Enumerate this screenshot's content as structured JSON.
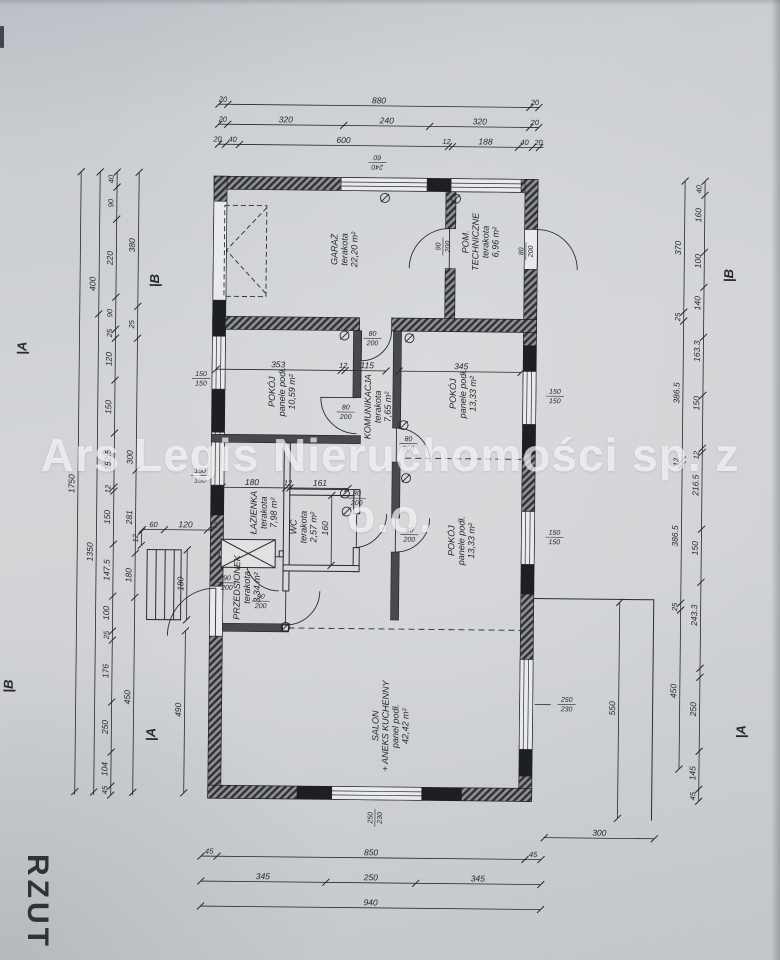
{
  "watermark": {
    "line1": "Ars Legis Nieruchomości sp. z",
    "line2": "o.o."
  },
  "title_block": {
    "label": "RZUT"
  },
  "colors": {
    "paper": "#d3d5d8",
    "ink": "#26282a",
    "wall_dark": "#47494c",
    "watermark": "rgba(255,255,255,0.66)"
  },
  "plan": {
    "rooms": [
      {
        "name_lines": [
          "GARAŻ"
        ],
        "finish": "terakota",
        "area": "22,20 m²",
        "x": 345,
        "y": 250
      },
      {
        "name_lines": [
          "POM.",
          "TECHNICZNE"
        ],
        "finish": "terakota",
        "area": "6,96 m²",
        "x": 481,
        "y": 241
      },
      {
        "name_lines": [
          "POKÓJ"
        ],
        "finish": "panele podł.",
        "area": "10,59 m²",
        "x": 284,
        "y": 393
      },
      {
        "name_lines": [
          "KOMUNIKACJA"
        ],
        "finish": "terakota",
        "area": "7,65 m²",
        "x": 380,
        "y": 407
      },
      {
        "name_lines": [
          "POKÓJ"
        ],
        "finish": "panele podł.",
        "area": "13,33 m²",
        "x": 465,
        "y": 393
      },
      {
        "name_lines": [
          "ŁAZIENKA"
        ],
        "finish": "terakota",
        "area": "7,98 m²",
        "x": 267,
        "y": 514
      },
      {
        "name_lines": [
          "WC"
        ],
        "finish": "terakota",
        "area": "2,57 m²",
        "x": 307,
        "y": 528
      },
      {
        "name_lines": [
          "PRZEDSIONEK"
        ],
        "finish": "terakota",
        "area": "3,34 m²",
        "x": 251,
        "y": 589
      },
      {
        "name_lines": [
          "POKÓJ"
        ],
        "finish": "panele podł.",
        "area": "13,33 m²",
        "x": 465,
        "y": 540
      },
      {
        "name_lines": [
          "SALON",
          "+ ANEKS KUCHENNY"
        ],
        "finish": "panel podł.",
        "area": "42,42 m²",
        "x": 396,
        "y": 726
      }
    ],
    "hdims": [
      {
        "y": 106,
        "x1": 215,
        "x2": 535,
        "ticks": [
          215,
          224,
          526,
          535
        ],
        "labels": [
          {
            "t": "20",
            "x": 219
          },
          {
            "t": "880",
            "x": 375
          },
          {
            "t": "20",
            "x": 531
          }
        ]
      },
      {
        "y": 126,
        "x1": 215,
        "x2": 535,
        "ticks": [
          215,
          224,
          340,
          426,
          526,
          535
        ],
        "labels": [
          {
            "t": "20",
            "x": 219
          },
          {
            "t": "320",
            "x": 282
          },
          {
            "t": "240",
            "x": 383
          },
          {
            "t": "320",
            "x": 476
          },
          {
            "t": "20",
            "x": 531
          }
        ]
      },
      {
        "y": 146,
        "x1": 215,
        "x2": 540,
        "ticks": [
          215,
          222,
          236,
          445,
          449,
          515,
          529,
          536
        ],
        "labels": [
          {
            "t": "20",
            "x": 214
          },
          {
            "t": "40",
            "x": 229
          },
          {
            "t": "600",
            "x": 340
          },
          {
            "t": "12",
            "x": 443
          },
          {
            "t": "188",
            "x": 482
          },
          {
            "t": "40",
            "x": 521
          },
          {
            "t": "20",
            "x": 535
          }
        ]
      },
      {
        "y": 858,
        "x1": 205,
        "x2": 545,
        "ticks": [
          205,
          221,
          529,
          545
        ],
        "labels": [
          {
            "t": "45",
            "x": 213
          },
          {
            "t": "850",
            "x": 375
          },
          {
            "t": "45",
            "x": 537
          }
        ]
      },
      {
        "y": 883,
        "x1": 205,
        "x2": 545,
        "ticks": [
          205,
          330,
          420,
          545
        ],
        "labels": [
          {
            "t": "345",
            "x": 267
          },
          {
            "t": "250",
            "x": 375
          },
          {
            "t": "345",
            "x": 482
          }
        ]
      },
      {
        "y": 908,
        "x1": 205,
        "x2": 545,
        "ticks": [
          205,
          545
        ],
        "labels": [
          {
            "t": "940",
            "x": 375
          }
        ]
      },
      {
        "y": 836,
        "x1": 548,
        "x2": 658,
        "ticks": [
          548,
          658
        ],
        "labels": [
          {
            "t": "300",
            "x": 603
          }
        ]
      },
      {
        "y": 532,
        "x1": 143,
        "x2": 212,
        "ticks": [
          143,
          165,
          208
        ],
        "labels": [
          {
            "t": "60",
            "x": 154
          },
          {
            "t": "120",
            "x": 186
          },
          {
            "t": "12",
            "x": 214
          }
        ]
      },
      {
        "y": 371,
        "x1": 215,
        "x2": 385,
        "ticks": [
          215,
          340,
          344,
          385
        ],
        "labels": [
          {
            "t": "353",
            "x": 277
          },
          {
            "t": "12",
            "x": 342
          },
          {
            "t": "115",
            "x": 366
          }
        ]
      },
      {
        "y": 371,
        "x1": 398,
        "x2": 520,
        "ticks": [
          398,
          520
        ],
        "labels": [
          {
            "t": "345",
            "x": 460
          }
        ]
      },
      {
        "y": 489,
        "x1": 222,
        "x2": 348,
        "ticks": [
          222,
          286,
          290,
          348
        ],
        "labels": [
          {
            "t": "180",
            "x": 252
          },
          {
            "t": "12",
            "x": 288
          },
          {
            "t": "161",
            "x": 320
          }
        ]
      }
    ],
    "vdims": [
      {
        "x": 114,
        "y1": 175,
        "y2": 798,
        "ticks": [
          175,
          190,
          222,
          300,
          332,
          341,
          383,
          436,
          490,
          494,
          547,
          599,
          634,
          643,
          705,
          755,
          789,
          798
        ],
        "labels": [
          {
            "t": "40",
            "y": 182
          },
          {
            "t": "90",
            "y": 206
          },
          {
            "t": "220",
            "y": 261
          },
          {
            "t": "90",
            "y": 316
          },
          {
            "t": "25",
            "y": 336
          },
          {
            "t": "120",
            "y": 362
          },
          {
            "t": "150",
            "y": 410
          },
          {
            "t": "152.5",
            "y": 463
          },
          {
            "t": "12",
            "y": 492
          },
          {
            "t": "150",
            "y": 520
          },
          {
            "t": "147.5",
            "y": 573
          },
          {
            "t": "100",
            "y": 616
          },
          {
            "t": "25",
            "y": 638
          },
          {
            "t": "176",
            "y": 674
          },
          {
            "t": "250",
            "y": 730
          },
          {
            "t": "104",
            "y": 772
          },
          {
            "t": "45",
            "y": 793
          }
        ]
      },
      {
        "x": 136,
        "y1": 175,
        "y2": 798,
        "ticks": [
          175,
          309,
          341,
          473,
          556,
          600,
          795
        ],
        "labels": [
          {
            "t": "380",
            "y": 248
          },
          {
            "t": "25",
            "y": 327
          },
          {
            "t": "300",
            "y": 460
          },
          {
            "t": "281",
            "y": 520
          },
          {
            "t": "180",
            "y": 578
          },
          {
            "t": "450",
            "y": 700
          }
        ]
      },
      {
        "x": 97,
        "y1": 175,
        "y2": 798,
        "ticks": [
          175,
          317,
          795
        ],
        "labels": [
          {
            "t": "400",
            "y": 287
          },
          {
            "t": "1350",
            "y": 555
          }
        ]
      },
      {
        "x": 78,
        "y1": 175,
        "y2": 798,
        "ticks": [
          175,
          795
        ],
        "labels": [
          {
            "t": "1750",
            "y": 487
          }
        ]
      },
      {
        "x": 188,
        "y1": 552,
        "y2": 622,
        "ticks": [
          552,
          622
        ],
        "labels": [
          {
            "t": "180",
            "y": 586
          }
        ]
      },
      {
        "x": 187,
        "y1": 633,
        "y2": 795,
        "ticks": [
          633,
          795
        ],
        "labels": [
          {
            "t": "490",
            "y": 712
          }
        ]
      },
      {
        "x": 332,
        "y1": 496,
        "y2": 566,
        "ticks": [
          496,
          566
        ],
        "labels": [
          {
            "t": "160",
            "y": 529
          }
        ]
      },
      {
        "x": 142,
        "y1": 534,
        "y2": 548,
        "ticks": [
          534,
          548
        ],
        "labels": [
          {
            "t": "12",
            "y": 541
          }
        ]
      },
      {
        "x": 682,
        "y1": 178,
        "y2": 766,
        "ticks": [
          178,
          309,
          318,
          457,
          462,
          600,
          607,
          766
        ],
        "labels": [
          {
            "t": "370",
            "y": 245
          },
          {
            "t": "25",
            "y": 314
          },
          {
            "t": "386.5",
            "y": 390
          },
          {
            "t": "12",
            "y": 459
          },
          {
            "t": "386.5",
            "y": 533
          },
          {
            "t": "25",
            "y": 604
          },
          {
            "t": "450",
            "y": 688
          }
        ]
      },
      {
        "x": 702,
        "y1": 178,
        "y2": 798,
        "ticks": [
          178,
          192,
          249,
          284,
          334,
          392,
          445,
          449,
          526,
          579,
          665,
          674,
          748,
          786,
          798
        ],
        "labels": [
          {
            "t": "40",
            "y": 186
          },
          {
            "t": "160",
            "y": 212
          },
          {
            "t": "100",
            "y": 258
          },
          {
            "t": "140",
            "y": 300
          },
          {
            "t": "163.3",
            "y": 348
          },
          {
            "t": "150",
            "y": 400
          },
          {
            "t": "12",
            "y": 452
          },
          {
            "t": "216.5",
            "y": 482
          },
          {
            "t": "150",
            "y": 545
          },
          {
            "t": "243.3",
            "y": 612
          },
          {
            "t": "250",
            "y": 706
          },
          {
            "t": "145",
            "y": 770
          },
          {
            "t": "45",
            "y": 793
          }
        ]
      },
      {
        "x": 621,
        "y1": 600,
        "y2": 816,
        "ticks": [
          600,
          816
        ],
        "labels": [
          {
            "t": "550",
            "y": 706
          }
        ]
      }
    ],
    "opening_labels": [
      {
        "top": "90",
        "bottom": "200",
        "x": 440,
        "y": 246,
        "rot": -90
      },
      {
        "top": "80",
        "bottom": "200",
        "x": 523,
        "y": 250,
        "rot": -90
      },
      {
        "top": "80",
        "bottom": "200",
        "x": 371,
        "y": 338,
        "rot": 0
      },
      {
        "top": "80",
        "bottom": "200",
        "x": 345,
        "y": 412,
        "rot": 0
      },
      {
        "top": "80",
        "bottom": "200",
        "x": 408,
        "y": 443,
        "rot": 0
      },
      {
        "top": "80",
        "bottom": "200",
        "x": 410,
        "y": 534,
        "rot": 0
      },
      {
        "top": "80",
        "bottom": "200",
        "x": 357,
        "y": 498,
        "rot": 0
      },
      {
        "top": "90",
        "bottom": "200",
        "x": 262,
        "y": 602,
        "rot": 0
      },
      {
        "top": "90",
        "bottom": "200",
        "x": 228,
        "y": 584,
        "rot": 0
      },
      {
        "top": "150",
        "bottom": "150",
        "x": 200,
        "y": 380,
        "rot": 0
      },
      {
        "top": "150",
        "bottom": "150",
        "x": 200,
        "y": 477,
        "rot": 0
      },
      {
        "top": "150",
        "bottom": "150",
        "x": 554,
        "y": 394,
        "rot": 0
      },
      {
        "top": "150",
        "bottom": "150",
        "x": 555,
        "y": 535,
        "rot": 0
      },
      {
        "top": "240",
        "bottom": "60",
        "x": 374,
        "y": 163,
        "rot": 180
      },
      {
        "top": "250",
        "bottom": "230",
        "x": 378,
        "y": 818,
        "rot": -90
      },
      {
        "top": "250",
        "bottom": "230",
        "x": 569,
        "y": 702,
        "rot": 0
      }
    ],
    "section_markers": [
      {
        "t": "|B",
        "x": 157,
        "y": 283
      },
      {
        "t": "|A",
        "x": 25,
        "y": 352
      },
      {
        "t": "|B",
        "x": 15,
        "y": 690
      },
      {
        "t": "|A",
        "x": 158,
        "y": 737
      },
      {
        "t": "|B",
        "x": 731,
        "y": 272
      },
      {
        "t": "|A",
        "x": 748,
        "y": 728
      }
    ],
    "symbols": {
      "circle_slash": [
        [
          382,
          198
        ],
        [
          453,
          198
        ],
        [
          343,
          336
        ],
        [
          408,
          338
        ],
        [
          345,
          494
        ],
        [
          347,
          512
        ],
        [
          403,
          425
        ],
        [
          406,
          478
        ],
        [
          287,
          628
        ]
      ]
    }
  }
}
